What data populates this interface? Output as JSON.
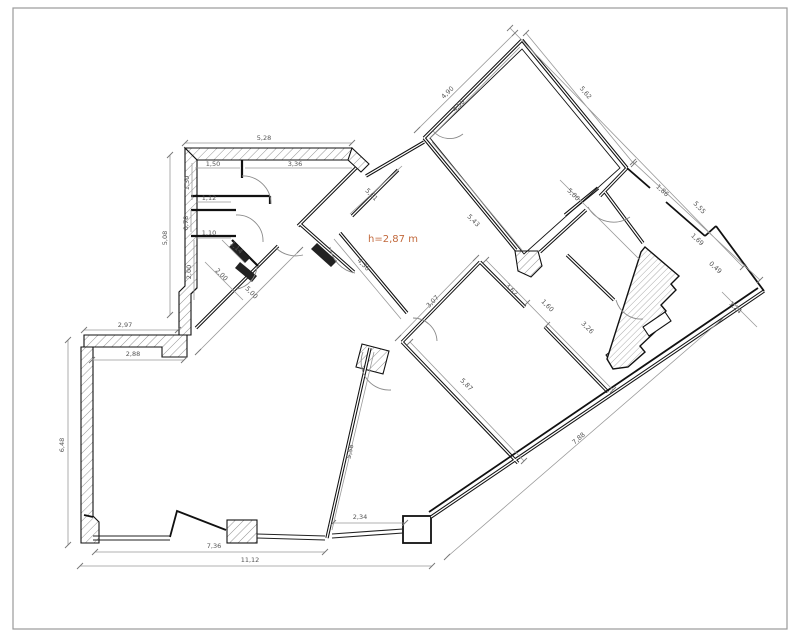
{
  "sheet": {
    "note": "h=2,87 m",
    "note_color": "#c2693c",
    "wall_color": "#1a1a1a",
    "dim_color": "#999999"
  },
  "dims": {
    "d528": "5,28",
    "d508": "5,08",
    "d150": "1,50",
    "d336": "3,36",
    "d130": "1,30",
    "d112": "1,12",
    "d078": "0,78",
    "d110": "1,10",
    "d200a": "2,00",
    "d114": "1,14",
    "d200b": "2,00",
    "d500a": "5,00",
    "d297": "2,97",
    "d288": "2,88",
    "d648": "6,48",
    "d736": "7,36",
    "d1112": "11,12",
    "d234": "2,34",
    "d558": "5,58",
    "d561": "5,61",
    "d436": "4,36",
    "d307": "3,07",
    "d362": "3,62",
    "d160": "1,60",
    "d326": "3,26",
    "d587": "5,87",
    "d543": "5,43",
    "d490": "4,90",
    "d450": "4,50",
    "d562": "5,62",
    "d555": "5,55",
    "d500b": "5,00",
    "d186": "1,86",
    "d169": "1,69",
    "d049": "0,49",
    "d124": "1,24",
    "d788": "7,88"
  }
}
